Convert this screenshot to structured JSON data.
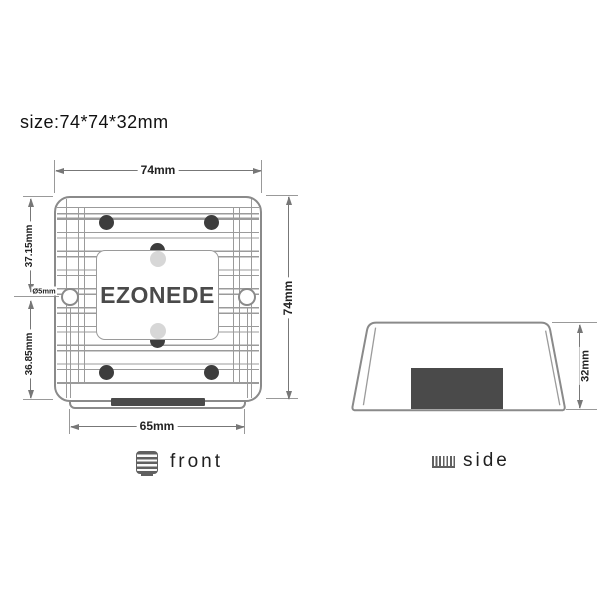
{
  "title": "size:74*74*32mm",
  "front_view": {
    "brand": "EZONEDE",
    "caption": "front",
    "dim_width_top": "74mm",
    "dim_height_right": "74mm",
    "dim_left_upper": "37.15mm",
    "dim_left_lower": "36.85mm",
    "dim_hole_diameter": "Ø5mm",
    "dim_width_bottom": "65mm"
  },
  "side_view": {
    "caption": "side",
    "dim_height": "32mm"
  },
  "colors": {
    "outline": "#8a8a8a",
    "dimension_line": "#777777",
    "dark_fill": "#4a4a4a",
    "text": "#1f1f1f"
  },
  "icons": {
    "front_icon": "front-view-icon",
    "side_icon": "side-view-icon"
  }
}
